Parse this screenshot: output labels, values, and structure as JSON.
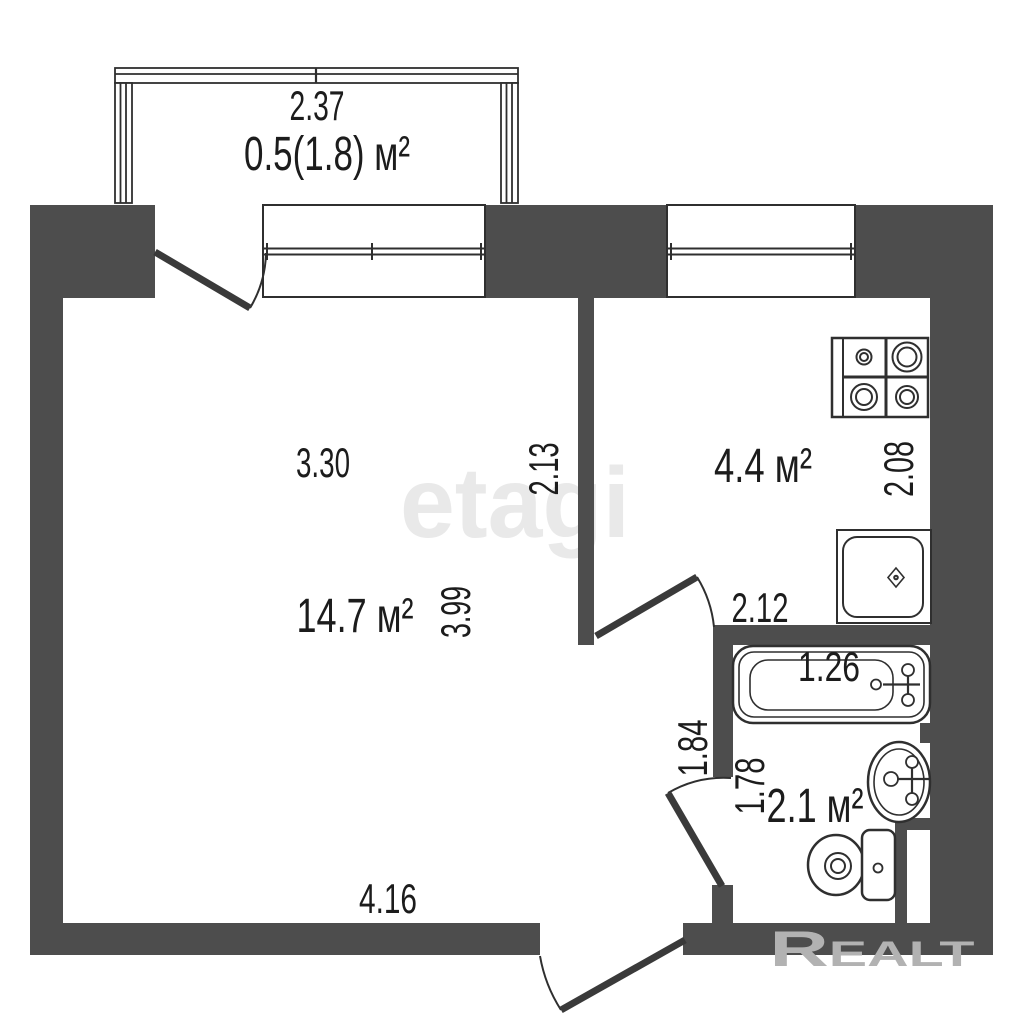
{
  "colors": {
    "background": "#ffffff",
    "wall": "#4d4d4d",
    "line": "#2f2f2f",
    "door_leaf": "#3a3a3a",
    "text": "#1c1c1c",
    "watermark_center": "#e9e9e9",
    "watermark_corner": "#b2b2b2"
  },
  "plan": {
    "balcony": {
      "width": "2.37",
      "area": "0.5(1.8) м²"
    },
    "living_room": {
      "area": "14.7 м²",
      "width_top": "3.30",
      "depth": "3.99",
      "width_bottom": "4.16",
      "partition_height": "2.13"
    },
    "kitchen": {
      "area": "4.4 м²",
      "depth": "2.08",
      "width_bottom": "2.12"
    },
    "bathroom": {
      "area": "2.1 м²",
      "bathtub_length": "1.26",
      "depth": "1.78",
      "hall_depth": "1.84"
    }
  },
  "watermarks": {
    "center": "etagi",
    "bottom_right": "Realt"
  }
}
